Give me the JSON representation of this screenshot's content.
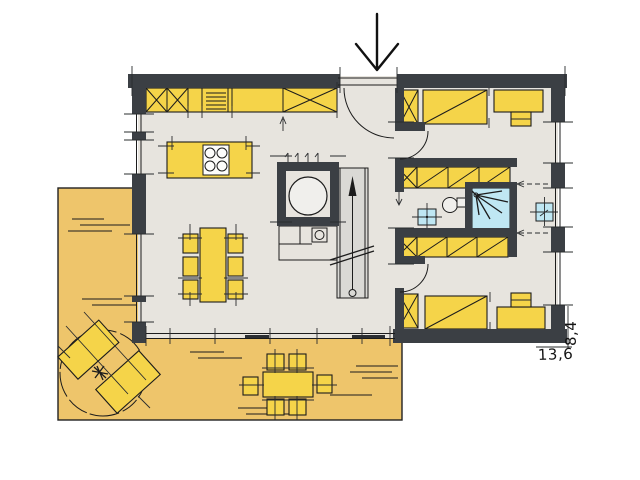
{
  "document": {
    "type": "architectural-floor-plan",
    "view": "ground-floor-with-terrace"
  },
  "dimensions": {
    "width_label": "13,6",
    "depth_label": "8,4"
  },
  "colors": {
    "background": "#ffffff",
    "wall": "#3b3f44",
    "floor": "#e7e4de",
    "terrace": "#eec56b",
    "furniture": "#f5d449",
    "water": "#bfe7f3",
    "stair": "#dad9d5",
    "line": "#1c1c1c"
  },
  "rooms": [
    {
      "name": "kitchen-living-dining",
      "features": [
        "kitchen-counter",
        "tall-cabinets-x",
        "oven-appliance",
        "kitchen-island-with-cooktop",
        "dining-table",
        "six-chairs",
        "glass-front-south"
      ]
    },
    {
      "name": "technical-room",
      "features": [
        "boiler-tank",
        "counter-with-sink",
        "coat-hooks"
      ]
    },
    {
      "name": "staircase",
      "features": [
        "up-arrow",
        "break-line",
        "newel-circle"
      ]
    },
    {
      "name": "entrance-hall",
      "features": [
        "entrance-door-swing",
        "entrance-arrow"
      ]
    },
    {
      "name": "bathroom",
      "features": [
        "toilet",
        "wash-basin",
        "shower",
        "wardrobe-bands"
      ]
    },
    {
      "name": "bedroom-top",
      "features": [
        "bed",
        "wardrobe-x",
        "desk",
        "chair",
        "door-swing"
      ]
    },
    {
      "name": "bedroom-bottom",
      "features": [
        "bed",
        "wardrobe-x",
        "desk",
        "chair",
        "door-swing"
      ]
    },
    {
      "name": "hallway-east",
      "features": [
        "wash-basin",
        "dashed-sight-arrows",
        "window"
      ]
    },
    {
      "name": "terrace",
      "features": [
        "tree",
        "two-sun-loungers",
        "outdoor-dining-table",
        "six-outdoor-chairs",
        "ground-texture-lines"
      ]
    }
  ],
  "symbols": {
    "entrance": "down-arrow",
    "stair_direction": "up-arrow",
    "shower": "spray-star"
  }
}
